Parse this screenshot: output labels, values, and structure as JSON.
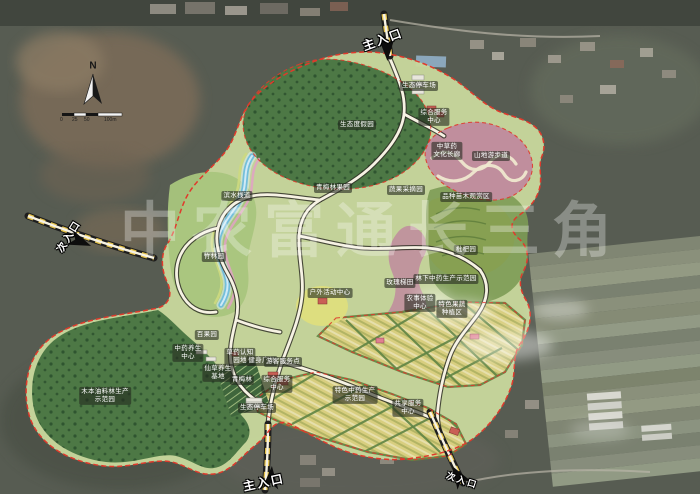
{
  "watermark": {
    "text": "中农富通长三角"
  },
  "compass": {
    "north_label": "N"
  },
  "scalebar": {
    "labels": [
      "0",
      "25",
      "50",
      "100m"
    ]
  },
  "palette": {
    "boundary-red": "#e03a2c",
    "road-fill": "#f6f2e3",
    "road-casing": "#2f2f26",
    "entrance-yellow": "#e2c04a",
    "park-base": "#c8d79c",
    "meadow": "#a9c57d",
    "forest-dark": "#4d7845",
    "forest-deep": "#2f5530",
    "farm-yellow": "#d8ce7f",
    "hedge-green": "#5f8444",
    "pink-garden": "#c08e9d",
    "water-blue": "#74bedb",
    "label-bg": "rgba(35,40,30,0.6)",
    "watermark": "rgba(255,255,255,0.3)"
  },
  "map": {
    "labels": [
      {
        "text": "主入口",
        "x": 383,
        "y": 40,
        "type": "entrance",
        "rot": -20,
        "name": "entrance-label-main-north"
      },
      {
        "text": "次入口",
        "x": 70,
        "y": 237,
        "type": "entrance",
        "rot": -58,
        "size": 10,
        "name": "entrance-label-secondary-west"
      },
      {
        "text": "主入口",
        "x": 264,
        "y": 483,
        "type": "entrance",
        "rot": -12,
        "name": "entrance-label-main-south"
      },
      {
        "text": "次入口",
        "x": 462,
        "y": 481,
        "type": "entrance",
        "rot": 18,
        "size": 9,
        "name": "entrance-label-secondary-southeast"
      },
      {
        "text": "生态停车场",
        "x": 419,
        "y": 86
      },
      {
        "text": "综合服务\n中心",
        "x": 434,
        "y": 117
      },
      {
        "text": "生态度假园",
        "x": 357,
        "y": 125
      },
      {
        "text": "中草药\n文化长廊",
        "x": 447,
        "y": 151
      },
      {
        "text": "山地游步道",
        "x": 491,
        "y": 156
      },
      {
        "text": "青梅林果园",
        "x": 333,
        "y": 188
      },
      {
        "text": "蔬果采摘园",
        "x": 406,
        "y": 190
      },
      {
        "text": "滨水栈道",
        "x": 237,
        "y": 196
      },
      {
        "text": "品种苗木观赏区",
        "x": 466,
        "y": 197
      },
      {
        "text": "竹林园",
        "x": 214,
        "y": 257
      },
      {
        "text": "枇杷园",
        "x": 466,
        "y": 250
      },
      {
        "text": "林下中药生产示范园",
        "x": 446,
        "y": 279
      },
      {
        "text": "玫瑰梯田",
        "x": 400,
        "y": 283
      },
      {
        "text": "户外活动中心",
        "x": 330,
        "y": 293
      },
      {
        "text": "农事体验\n中心",
        "x": 420,
        "y": 303
      },
      {
        "text": "特色果蔬\n种植区",
        "x": 452,
        "y": 309
      },
      {
        "text": "百果园",
        "x": 207,
        "y": 335
      },
      {
        "text": "中药养生\n中心",
        "x": 188,
        "y": 353
      },
      {
        "text": "草药认知\n园地",
        "x": 240,
        "y": 357
      },
      {
        "text": "健身广场",
        "x": 262,
        "y": 361
      },
      {
        "text": "游客服务点",
        "x": 283,
        "y": 362
      },
      {
        "text": "仙草养生\n基地",
        "x": 218,
        "y": 373
      },
      {
        "text": "青梅林",
        "x": 242,
        "y": 380
      },
      {
        "text": "综合服务\n中心",
        "x": 277,
        "y": 384
      },
      {
        "text": "木本油料林生产\n示范园",
        "x": 105,
        "y": 396
      },
      {
        "text": "特色中药生产\n示范园",
        "x": 355,
        "y": 395
      },
      {
        "text": "生态停车场",
        "x": 257,
        "y": 408
      },
      {
        "text": "共享服务\n中心",
        "x": 408,
        "y": 408
      }
    ]
  }
}
